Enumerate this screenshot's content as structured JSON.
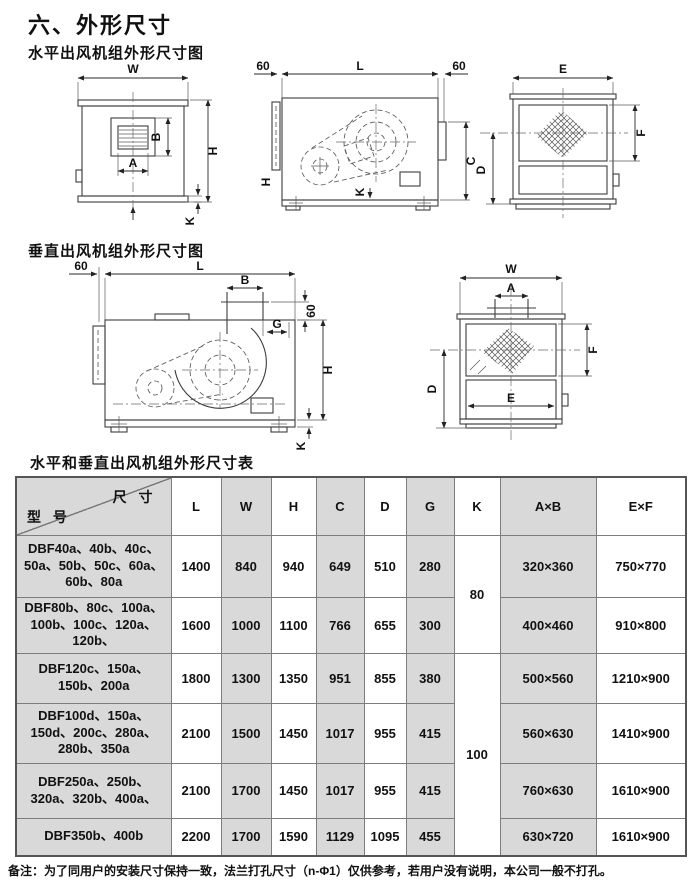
{
  "page": {
    "title": "六、外形尺寸",
    "horizontal_section_title": "水平出风机组外形尺寸图",
    "vertical_section_title": "垂直出风机组外形尺寸图",
    "table_title": "水平和垂直出风机组外形尺寸表",
    "note": "备注：为了同用户的安装尺寸保持一致，法兰打孔尺寸（n-Φ1）仅供参考，若用户没有说明，本公司一般不打孔。"
  },
  "labels": {
    "W": "W",
    "H": "H",
    "L": "L",
    "A": "A",
    "B": "B",
    "C": "C",
    "D": "D",
    "E": "E",
    "F": "F",
    "G": "G",
    "K": "K",
    "sixty": "60"
  },
  "table": {
    "corner": {
      "dim": "尺 寸",
      "model": "型 号"
    },
    "columns": [
      "L",
      "W",
      "H",
      "C",
      "D",
      "G",
      "K",
      "A×B",
      "E×F"
    ],
    "k_values": {
      "group1": "80",
      "group2": "100"
    },
    "rows": [
      {
        "model": "DBF40a、40b、40c、50a、50b、50c、60a、60b、80a",
        "l": "1400",
        "w": "840",
        "h": "940",
        "c": "649",
        "d": "510",
        "g": "280",
        "ab": "320×360",
        "ef": "750×770"
      },
      {
        "model": "DBF80b、80c、100a、100b、100c、120a、120b、",
        "l": "1600",
        "w": "1000",
        "h": "1100",
        "c": "766",
        "d": "655",
        "g": "300",
        "ab": "400×460",
        "ef": "910×800"
      },
      {
        "model": "DBF120c、150a、150b、200a",
        "l": "1800",
        "w": "1300",
        "h": "1350",
        "c": "951",
        "d": "855",
        "g": "380",
        "ab": "500×560",
        "ef": "1210×900"
      },
      {
        "model": "DBF100d、150a、150d、200c、280a、280b、350a",
        "l": "2100",
        "w": "1500",
        "h": "1450",
        "c": "1017",
        "d": "955",
        "g": "415",
        "ab": "560×630",
        "ef": "1410×900"
      },
      {
        "model": "DBF250a、250b、320a、320b、400a、",
        "l": "2100",
        "w": "1700",
        "h": "1450",
        "c": "1017",
        "d": "955",
        "g": "415",
        "ab": "760×630",
        "ef": "1610×900"
      },
      {
        "model": "DBF350b、400b",
        "l": "2200",
        "w": "1700",
        "h": "1590",
        "c": "1129",
        "d": "1095",
        "g": "455",
        "ab": "630×720",
        "ef": "1610×900"
      }
    ]
  }
}
